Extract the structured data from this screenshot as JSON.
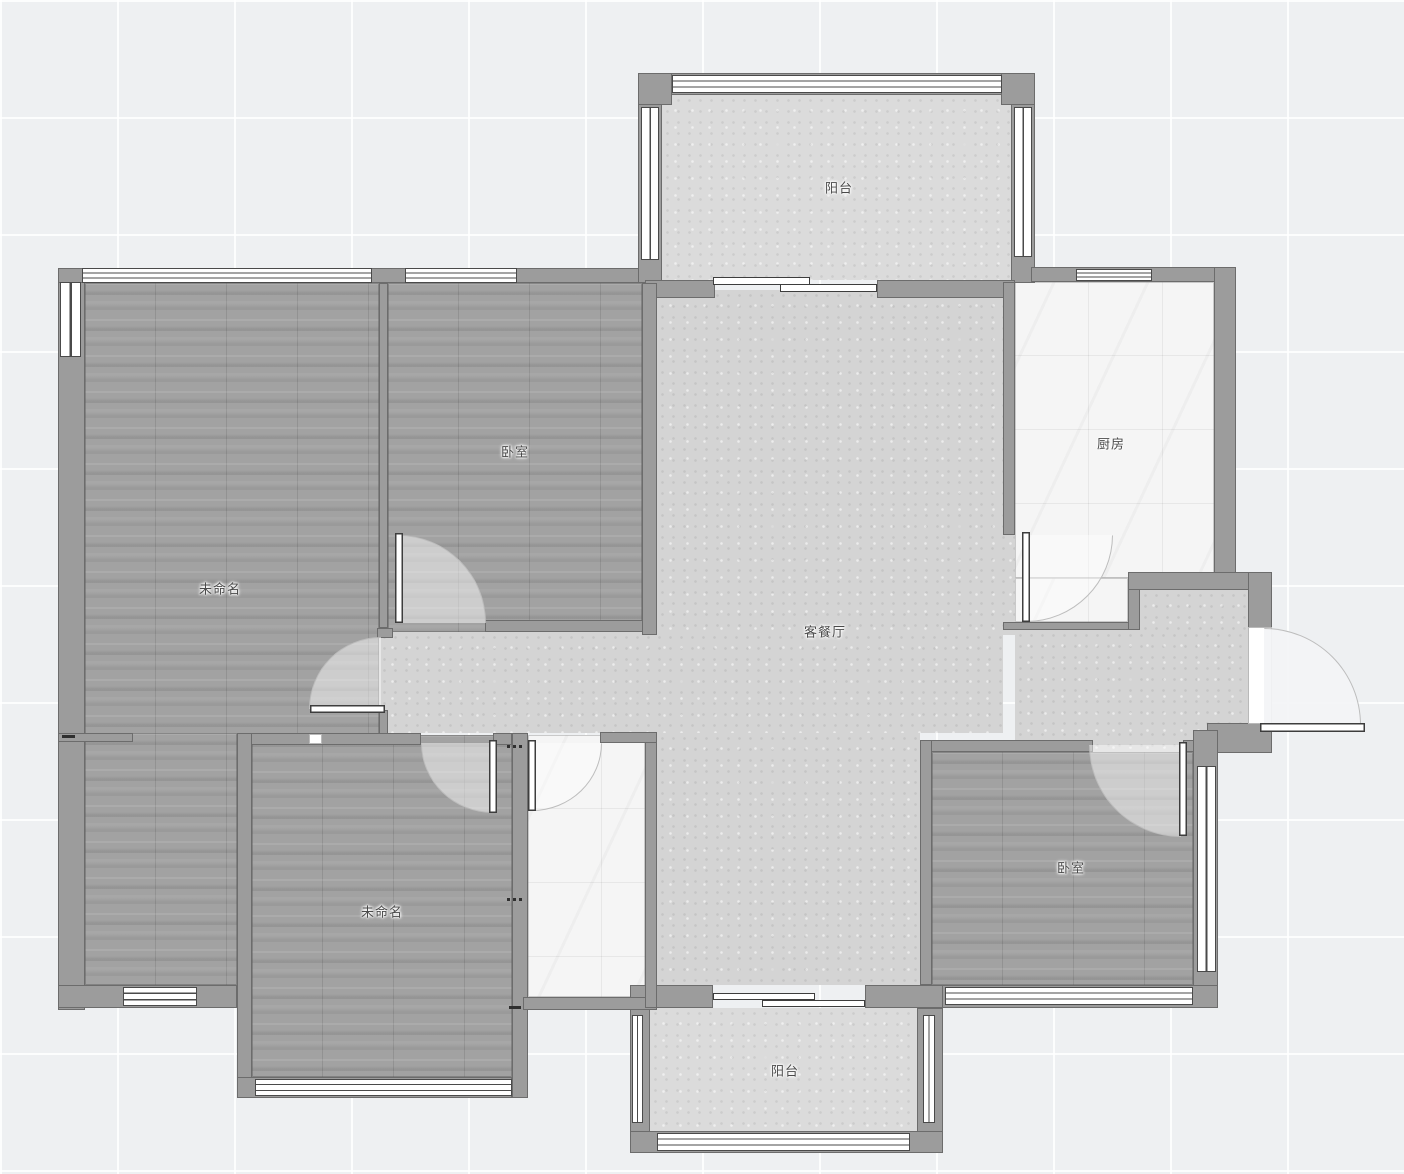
{
  "plan": {
    "type": "residential-floor-plan",
    "rooms": [
      {
        "id": "balcony-top",
        "label": "阳台",
        "floor": "stone"
      },
      {
        "id": "bedroom-top",
        "label": "卧室",
        "floor": "wood"
      },
      {
        "id": "room-top-left",
        "label": "未命名",
        "floor": "wood"
      },
      {
        "id": "kitchen",
        "label": "厨房",
        "floor": "tile"
      },
      {
        "id": "living-dining",
        "label": "客餐厅",
        "floor": "stone"
      },
      {
        "id": "room-bottom-left",
        "label": "未命名",
        "floor": "wood"
      },
      {
        "id": "bedroom-bottom",
        "label": "卧室",
        "floor": "wood"
      },
      {
        "id": "balcony-bottom",
        "label": "阳台",
        "floor": "stone"
      }
    ],
    "colors": {
      "wall": "#9c9c9c",
      "wall_outline": "#5e5e5e",
      "wood_floor": "#a2a2a2",
      "tile_floor": "#f5f5f5",
      "concrete_floor": "#d4d4d4",
      "background": "#eef0f2",
      "grid_line": "#ffffff",
      "door_arc": "#bdbdbd",
      "window_frame": "#4a4a4a",
      "label_text": "#4a4a4a"
    }
  }
}
